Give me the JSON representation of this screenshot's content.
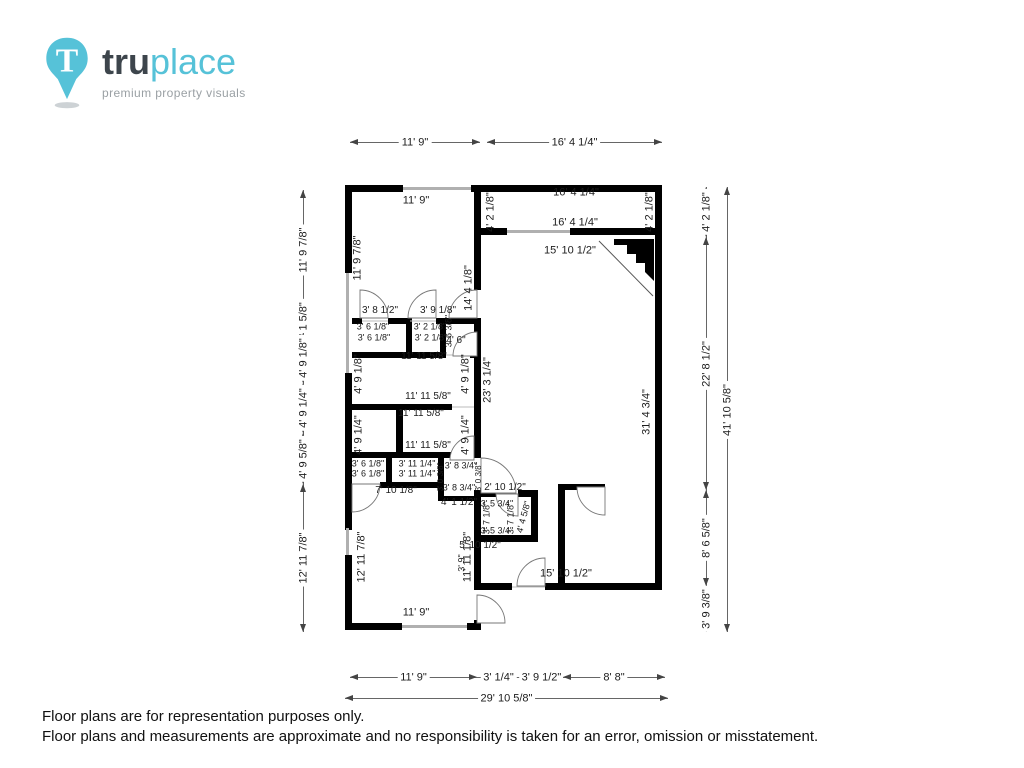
{
  "logo": {
    "brand_bold": "tru",
    "brand_light": "place",
    "tagline": "premium property visuals",
    "pin_letter": "T",
    "colors": {
      "teal": "#56c2d8",
      "dark_gray": "#3d454c",
      "tagline_gray": "#9aa0a4"
    }
  },
  "footer": {
    "line1": "Floor plans are for representation purposes only.",
    "line2": "Floor plans and measurements are approximate and no responsibility is taken for an error, omission or misstatement."
  },
  "floorplan": {
    "wall_color": "#000000",
    "window_color": "#b0b0b0",
    "dim_lines": [
      {
        "text": "11' 9\"",
        "o": "h",
        "x": 350,
        "y": 142,
        "len": 130
      },
      {
        "text": "16' 4 1/4\"",
        "o": "h",
        "x": 487,
        "y": 142,
        "len": 175
      },
      {
        "text": "11' 9\"",
        "o": "h",
        "x": 350,
        "y": 677,
        "len": 127
      },
      {
        "text": "3' 1/4\"",
        "o": "h",
        "x": 477,
        "y": 677,
        "len": 43,
        "arrows": false
      },
      {
        "text": "3' 9 1/2\"",
        "o": "h",
        "x": 520,
        "y": 677,
        "len": 43,
        "arrows": false
      },
      {
        "text": "8' 8\"",
        "o": "h",
        "x": 563,
        "y": 677,
        "len": 102
      },
      {
        "text": "29' 10 5/8\"",
        "o": "h",
        "x": 345,
        "y": 698,
        "len": 323
      },
      {
        "text": "11' 9 7/8\"",
        "o": "v",
        "x": 303,
        "y": 190,
        "len": 120
      },
      {
        "text": "2' 1 5/8\"",
        "o": "v",
        "x": 303,
        "y": 310,
        "len": 23,
        "arrows": false
      },
      {
        "text": "4' 9 1/8\"",
        "o": "v",
        "x": 303,
        "y": 333,
        "len": 50
      },
      {
        "text": "4' 9 1/4\"",
        "o": "v",
        "x": 303,
        "y": 383,
        "len": 50
      },
      {
        "text": "4' 9 5/8\"",
        "o": "v",
        "x": 303,
        "y": 433,
        "len": 51
      },
      {
        "text": "12' 11 7/8\"",
        "o": "v",
        "x": 303,
        "y": 484,
        "len": 148
      },
      {
        "text": "4' 2 1/8\"",
        "o": "v",
        "x": 706,
        "y": 187,
        "len": 50
      },
      {
        "text": "22' 8 1/2\"",
        "o": "v",
        "x": 706,
        "y": 237,
        "len": 253
      },
      {
        "text": "8' 6 5/8\"",
        "o": "v",
        "x": 706,
        "y": 490,
        "len": 96
      },
      {
        "text": "3' 9 3/8\"",
        "o": "v",
        "x": 706,
        "y": 586,
        "len": 46
      },
      {
        "text": "41' 10 5/8\"",
        "o": "v",
        "x": 727,
        "y": 187,
        "len": 445
      }
    ],
    "labels": [
      {
        "text": "11' 9\"",
        "x": 416,
        "y": 201
      },
      {
        "text": "16' 4 1/4\"",
        "x": 576,
        "y": 193
      },
      {
        "text": "4' 2 1/8\"",
        "x": 491,
        "y": 212,
        "rot": -90
      },
      {
        "text": "4' 2 1/8\"",
        "x": 650,
        "y": 212,
        "rot": -90
      },
      {
        "text": "16' 4 1/4\"",
        "x": 575,
        "y": 223
      },
      {
        "text": "15' 10 1/2\"",
        "x": 570,
        "y": 251
      },
      {
        "text": "11' 9 7/8\"",
        "x": 358,
        "y": 258,
        "rot": -90
      },
      {
        "text": "14' 4 1/8\"",
        "x": 469,
        "y": 288,
        "rot": -90
      },
      {
        "text": "3' 8 1/2\"",
        "x": 380,
        "y": 311,
        "size": 10
      },
      {
        "text": "3' 9 1/8\"",
        "x": 438,
        "y": 311,
        "size": 10
      },
      {
        "text": "3' 6 1/8\"",
        "x": 373,
        "y": 327,
        "size": 9
      },
      {
        "text": "3' 2 1/8\"",
        "x": 430,
        "y": 327,
        "size": 9
      },
      {
        "text": "3' 6 1/8\"",
        "x": 374,
        "y": 338,
        "size": 9
      },
      {
        "text": "3' 2 1/8\"",
        "x": 431,
        "y": 338,
        "size": 9
      },
      {
        "text": "3' 6 3/8\"",
        "x": 449,
        "y": 331,
        "rot": -90,
        "size": 9
      },
      {
        "text": "4' 6\"",
        "x": 456,
        "y": 341,
        "size": 10
      },
      {
        "text": "11' 11 5/8\"",
        "x": 424,
        "y": 357,
        "size": 10
      },
      {
        "text": "4' 9 1/8\"",
        "x": 359,
        "y": 374,
        "rot": -90
      },
      {
        "text": "4' 9 1/8\"",
        "x": 466,
        "y": 374,
        "rot": -90
      },
      {
        "text": "23' 3 1/4\"",
        "x": 488,
        "y": 380,
        "rot": -90
      },
      {
        "text": "11' 11 5/8\"",
        "x": 428,
        "y": 397,
        "size": 10
      },
      {
        "text": "11' 11 5/8\"",
        "x": 421,
        "y": 414,
        "size": 10
      },
      {
        "text": "4' 9 1/4\"",
        "x": 359,
        "y": 435,
        "rot": -90
      },
      {
        "text": "4' 9 1/4\"",
        "x": 466,
        "y": 435,
        "rot": -90
      },
      {
        "text": "31' 4 3/4\"",
        "x": 647,
        "y": 412,
        "rot": -90
      },
      {
        "text": "11' 11 5/8\"",
        "x": 428,
        "y": 446,
        "size": 10
      },
      {
        "text": "3' 6 1/8\"",
        "x": 368,
        "y": 464,
        "size": 9
      },
      {
        "text": "3' 11 1/4\"",
        "x": 417,
        "y": 464,
        "size": 9
      },
      {
        "text": "3' 8 3/4\"",
        "x": 461,
        "y": 466,
        "size": 9
      },
      {
        "text": "3' 6 1/8\"",
        "x": 368,
        "y": 474,
        "size": 9
      },
      {
        "text": "3' 11 1/4\"",
        "x": 417,
        "y": 474,
        "size": 9
      },
      {
        "text": "3' 0 3/8\"",
        "x": 441,
        "y": 477,
        "rot": -90,
        "size": 8
      },
      {
        "text": "3' 0 3/8\"",
        "x": 479,
        "y": 477,
        "rot": -90,
        "size": 8
      },
      {
        "text": "3' 8 3/4\"",
        "x": 459,
        "y": 488,
        "size": 9
      },
      {
        "text": "2' 10 1/2\"",
        "x": 505,
        "y": 488,
        "size": 10
      },
      {
        "text": "7' 10 1/8\"",
        "x": 396,
        "y": 491,
        "size": 10
      },
      {
        "text": "4' 1 1/2\"",
        "x": 459,
        "y": 503,
        "size": 10
      },
      {
        "text": "3' 5 3/4\"",
        "x": 497,
        "y": 504,
        "size": 9
      },
      {
        "text": "3' 7 1/8\"",
        "x": 487,
        "y": 518,
        "rot": -90,
        "size": 9
      },
      {
        "text": "3' 7 1/8\"",
        "x": 511,
        "y": 518,
        "rot": -90,
        "size": 9
      },
      {
        "text": "4' 4 5/8\"",
        "x": 524,
        "y": 517,
        "rot": -75,
        "size": 9
      },
      {
        "text": "3' 5 3/4\"",
        "x": 497,
        "y": 531,
        "size": 9
      },
      {
        "text": "5' 10 1/2\"",
        "x": 480,
        "y": 546,
        "size": 10
      },
      {
        "text": "3' 9\"",
        "x": 462,
        "y": 563,
        "rot": -90,
        "size": 9
      },
      {
        "text": "15' 10 1/2\"",
        "x": 566,
        "y": 574
      },
      {
        "text": "12' 11 7/8\"",
        "x": 362,
        "y": 557,
        "rot": -90
      },
      {
        "text": "11' 11 1/8\"",
        "x": 468,
        "y": 557,
        "rot": -90
      },
      {
        "text": "11' 9\"",
        "x": 416,
        "y": 613
      }
    ]
  }
}
